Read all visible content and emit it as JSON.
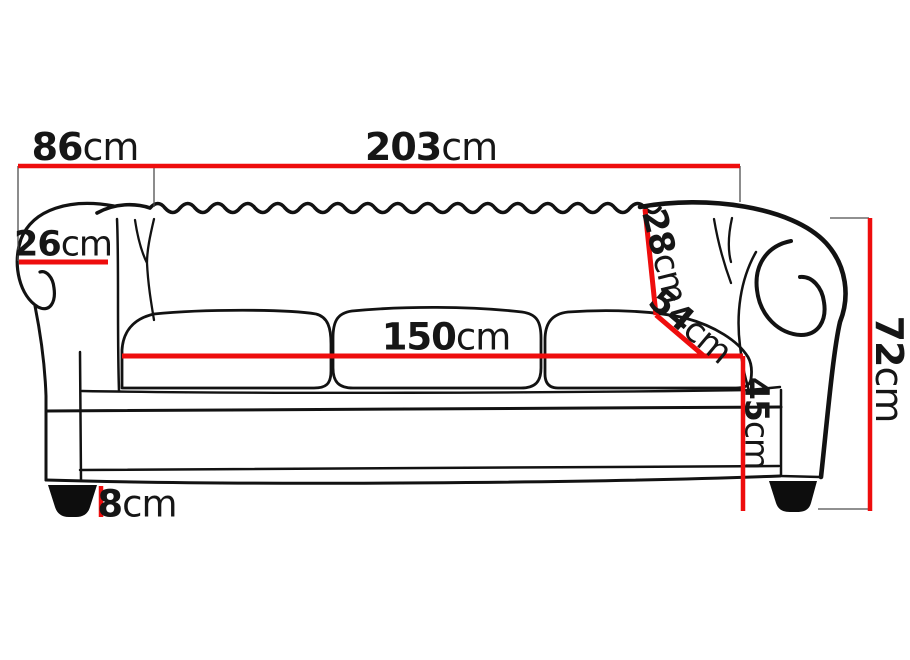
{
  "diagram": {
    "kind": "sofa-dimension-drawing",
    "subject": "three-seat chesterfield sofa, front elevation with measurements"
  },
  "colors": {
    "dimension_line": "#ee0d0d",
    "drawing_line": "#121212",
    "guide_line": "#4d4d4d",
    "text": "#161616",
    "background": "#ffffff"
  },
  "dimensions": {
    "arm_section_width": {
      "value": "86",
      "unit": "cm"
    },
    "overall_width": {
      "value": "203",
      "unit": "cm"
    },
    "arm_roll_width": {
      "value": "26",
      "unit": "cm"
    },
    "backrest_height": {
      "value": "28",
      "unit": "cm"
    },
    "seat_diagonal": {
      "value": "54",
      "unit": "cm"
    },
    "seat_width": {
      "value": "150",
      "unit": "cm"
    },
    "seat_height": {
      "value": "45",
      "unit": "cm"
    },
    "overall_height": {
      "value": "72",
      "unit": "cm"
    },
    "leg_height": {
      "value": "8",
      "unit": "cm"
    }
  }
}
